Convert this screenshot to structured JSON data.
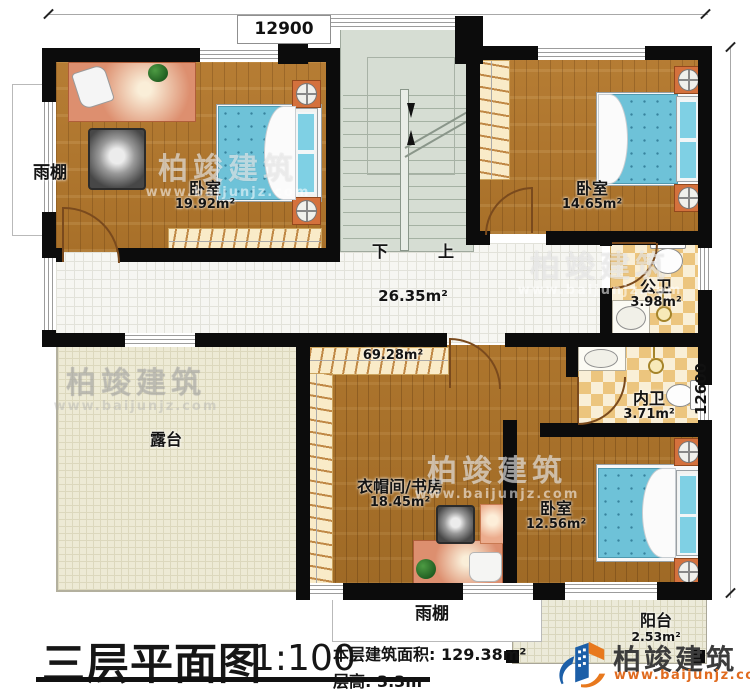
{
  "plan": {
    "dimensions": {
      "top": "12900",
      "right": "12600"
    },
    "stairs": {
      "down": "下",
      "up": "上"
    },
    "rooms": {
      "bedroom_tl": {
        "name": "卧室",
        "area": "19.92m²"
      },
      "bedroom_tr": {
        "name": "卧室",
        "area": "14.65m²"
      },
      "public_bath": {
        "name": "公卫",
        "area": "3.98m²"
      },
      "private_bath": {
        "name": "内卫",
        "area": "3.71m²"
      },
      "bedroom_br": {
        "name": "卧室",
        "area": "12.56m²"
      },
      "cloak_study": {
        "name": "衣帽间/书房",
        "area": "18.45m²"
      },
      "hall": {
        "area": "26.35m²"
      },
      "upper_zone": {
        "area": "69.28m²"
      },
      "terrace": {
        "name": "露台"
      },
      "balcony": {
        "name": "阳台",
        "area": "2.53m²"
      },
      "canopy_left": {
        "name": "雨棚"
      },
      "canopy_bottom": {
        "name": "雨棚"
      }
    }
  },
  "title": {
    "main": "三层平面图",
    "scale": "1:100",
    "area_line": "本层建筑面积: 129.38m²",
    "floor_height_line": "层高: 3.3m"
  },
  "brand": {
    "name": "柏竣建筑",
    "website": "www.baijunjz.com"
  },
  "watermark": {
    "name": "柏竣建筑",
    "website": "www.baijunjz.com"
  }
}
